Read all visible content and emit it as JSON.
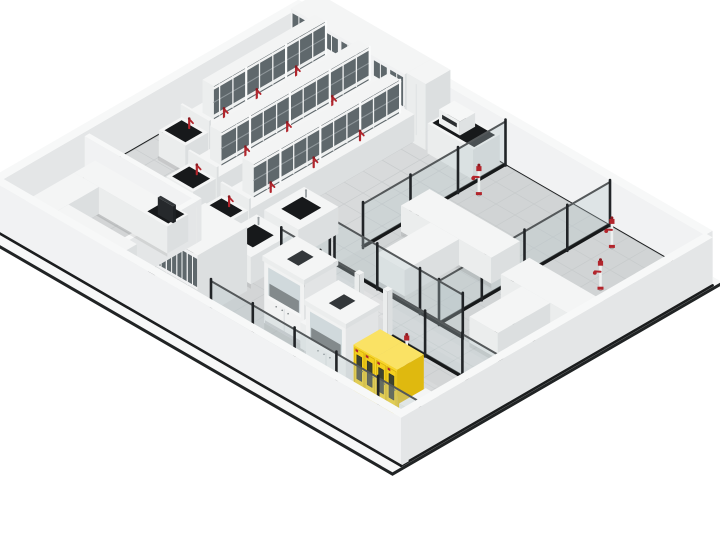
{
  "meta": {
    "title": "Isometric 3D render of a laboratory floor plan",
    "background": "#ffffff"
  },
  "colors": {
    "bg": "#ffffff",
    "apron": "#f7f8f8",
    "apron_edge": "#212425",
    "floor": "#d8dadb",
    "tile": "#c6c9ca",
    "tint_right": "#d1d4d5",
    "tint_corridor": "#dadcdd",
    "tint_front": "#d3d5d6",
    "strip": "#17191a",
    "wall_top": "#f7f8f8",
    "wall_face": "#f1f2f3",
    "wall_face_dark": "#e4e6e7",
    "wall_base": "#1b1d1e",
    "white_top": "#f4f5f5",
    "white_left": "#ebeded",
    "white_right": "#dcdfe0",
    "glass_fill": "rgba(185,198,203,0.32)",
    "glass_rail": "#54585a",
    "post": "#212427",
    "pane": "#5f686c",
    "pane_frame": "#f2f3f3",
    "shelf_line": "#8f979b",
    "black_top": "#17191b",
    "red": "#b2252c",
    "red_dark": "#8c1b22",
    "yellow_top": "#fae264",
    "yellow_front": "#f8d52b",
    "yellow_side": "#dfb90f",
    "yellow_door": "#f4cf1e",
    "yellow_window": "#3e422f",
    "sash": "#ccd6d9",
    "hood_interior": "#43484a",
    "steel": "#9aa0a3",
    "screen": "#2b2e30"
  },
  "projection": {
    "ox": 306,
    "oy": 50,
    "kx": 0.95,
    "ky": 0.55
  },
  "floor": {
    "u": [
      0,
      420
    ],
    "v": [
      0,
      320
    ],
    "tile_step": 20
  },
  "apron": {
    "pts": [
      [
        -12,
        -8
      ],
      [
        431,
        -8
      ],
      [
        431,
        340
      ],
      [
        -12,
        340
      ]
    ]
  },
  "tints": [
    {
      "u": [
        210,
        420
      ],
      "v": [
        0,
        180
      ],
      "c": "tint_right"
    },
    {
      "u": [
        190,
        420
      ],
      "v": [
        180,
        216
      ],
      "c": "tint_corridor"
    },
    {
      "u": [
        0,
        420
      ],
      "v": [
        216,
        320
      ],
      "c": "tint_front"
    }
  ],
  "strips": [
    {
      "u": [
        200,
        360
      ],
      "v": [
        304,
        318
      ]
    },
    {
      "u": [
        118,
        126
      ],
      "v": [
        216,
        320
      ]
    }
  ],
  "reflections": [
    {
      "u": [
        220,
        400
      ],
      "v": [
        188,
        204
      ],
      "op": 0.16
    },
    {
      "u": [
        215,
        375
      ],
      "v": [
        236,
        250
      ],
      "op": 0.12
    },
    {
      "u": [
        20,
        120
      ],
      "v": [
        158,
        172
      ],
      "op": 0.1
    }
  ],
  "outer_walls": [
    {
      "name": "outer-wall-back-right",
      "u": [
        0,
        420
      ],
      "v": [
        -8,
        0
      ],
      "h": 46,
      "baseline": "v2"
    },
    {
      "name": "outer-wall-back-left",
      "u": [
        -8,
        0
      ],
      "v": [
        0,
        320
      ],
      "h": 46,
      "baseline": "u2"
    },
    {
      "name": "outer-wall-front-right",
      "u": [
        420,
        428
      ],
      "v": [
        0,
        328
      ],
      "h": 48,
      "baseline": "u2"
    },
    {
      "name": "outer-wall-front-left",
      "u": [
        -8,
        428
      ],
      "v": [
        320,
        328
      ],
      "h": 48,
      "baseline": "v2"
    }
  ],
  "cabinet_rows": [
    {
      "name": "storage-cabinet-row-back",
      "u": [
        14,
        134
      ],
      "v": [
        2,
        30
      ],
      "h": 66,
      "doors": 7
    },
    {
      "name": "storage-cabinet-row-left",
      "u": [
        144,
        188
      ],
      "v": [
        250,
        302
      ],
      "h": 64,
      "doors": 4
    }
  ],
  "locker": {
    "name": "locker-cabinet",
    "u": [
      134,
      154
    ],
    "v": [
      2,
      28
    ],
    "h": 66
  },
  "instrument_bench": {
    "name": "instrument-bench",
    "u": [
      158,
      206
    ],
    "v": [
      2,
      30
    ],
    "h": 30,
    "instrument": {
      "u": [
        164,
        186
      ],
      "v": [
        8,
        24
      ],
      "h": 14
    }
  },
  "island_benches": [
    {
      "name": "island-bench-1",
      "u0": 18,
      "w": 30,
      "v1": 12,
      "v2": 150,
      "taps": [
        0.3,
        0.6,
        0.85
      ]
    },
    {
      "name": "island-bench-2",
      "u0": 64,
      "w": 30,
      "v1": 12,
      "v2": 188,
      "taps": [
        0.28,
        0.55,
        0.8
      ]
    },
    {
      "name": "island-bench-3",
      "u0": 110,
      "w": 30,
      "v1": 26,
      "v2": 200,
      "taps": [
        0.3,
        0.58,
        0.84
      ]
    }
  ],
  "sink_islands": [
    {
      "name": "sink-island-1",
      "u": [
        148,
        184
      ],
      "v": [
        150,
        192
      ]
    },
    {
      "name": "sink-island-2",
      "u": [
        148,
        184
      ],
      "v": [
        200,
        242
      ]
    }
  ],
  "partitions": [
    {
      "name": "glass-partition-center",
      "axis": "u",
      "at": 210,
      "segs": [
        [
          0,
          150
        ],
        [
          185,
          216
        ]
      ]
    },
    {
      "name": "glass-partition-right-divider",
      "axis": "u",
      "at": 320,
      "segs": [
        [
          0,
          180
        ]
      ]
    },
    {
      "name": "glass-partition-mid-right",
      "axis": "v",
      "at": 180,
      "segs": [
        [
          210,
          345
        ],
        [
          380,
          420
        ]
      ]
    },
    {
      "name": "glass-partition-corridor-back",
      "axis": "v",
      "at": 216,
      "segs": [
        [
          190,
          272
        ],
        [
          302,
          420
        ]
      ],
      "caps": [
        272,
        302
      ]
    },
    {
      "name": "glass-partition-corridor-front",
      "axis": "v",
      "at": 300,
      "segs": [
        [
          200,
          420
        ]
      ]
    }
  ],
  "t_benches": [
    {
      "name": "work-table-t-1",
      "boxes": [
        [
          215,
          85,
          310,
          115
        ],
        [
          246,
          115,
          276,
          172
        ]
      ]
    },
    {
      "name": "work-table-t-2",
      "boxes": [
        [
          330,
          95,
          415,
          125
        ],
        [
          352,
          125,
          382,
          180
        ]
      ]
    }
  ],
  "side_benches": [
    {
      "name": "side-bench-between-hoods",
      "u": [
        268,
        288
      ],
      "v": [
        246,
        274
      ],
      "h": 26
    },
    {
      "name": "side-bench-right-of-cabinets",
      "u": [
        394,
        418
      ],
      "v": [
        268,
        296
      ],
      "h": 26
    }
  ],
  "fume_hoods": [
    {
      "name": "fume-hood-1",
      "u": [
        226,
        268
      ],
      "v": [
        236,
        270
      ],
      "h": 62
    },
    {
      "name": "fume-hood-2",
      "u": [
        288,
        330
      ],
      "v": [
        254,
        288
      ],
      "h": 62
    }
  ],
  "yellow_cabinets": [
    {
      "name": "safety-cabinet-yellow-1",
      "u": [
        340,
        363
      ],
      "v": [
        262,
        290
      ],
      "h": 52
    },
    {
      "name": "safety-cabinet-yellow-2",
      "u": [
        363,
        386
      ],
      "v": [
        262,
        290
      ],
      "h": 52
    }
  ],
  "eyewash_stations": [
    {
      "name": "eyewash-station-1",
      "u": 222,
      "v": 40
    },
    {
      "name": "eyewash-station-2",
      "u": 340,
      "v": 18
    },
    {
      "name": "eyewash-station-3",
      "u": 372,
      "v": 62
    },
    {
      "name": "eyewash-station-4",
      "u": 338,
      "v": 232
    }
  ],
  "office_room": {
    "name": "office-room",
    "walls": [
      {
        "u": [
          0,
          118
        ],
        "v": [
          228,
          233
        ],
        "h": 42
      },
      {
        "u": [
          113,
          118
        ],
        "v": [
          233,
          320
        ],
        "h": 42
      }
    ],
    "counters": [
      [
        14,
        236,
        112,
        258
      ],
      [
        14,
        258,
        40,
        312
      ],
      [
        40,
        290,
        112,
        312
      ]
    ],
    "mat": {
      "u": [
        88,
        110
      ],
      "v": [
        238,
        255
      ]
    },
    "monitor": {
      "u": [
        96,
        112
      ],
      "v": [
        249,
        252
      ],
      "h0": 27,
      "h1": 44
    }
  }
}
